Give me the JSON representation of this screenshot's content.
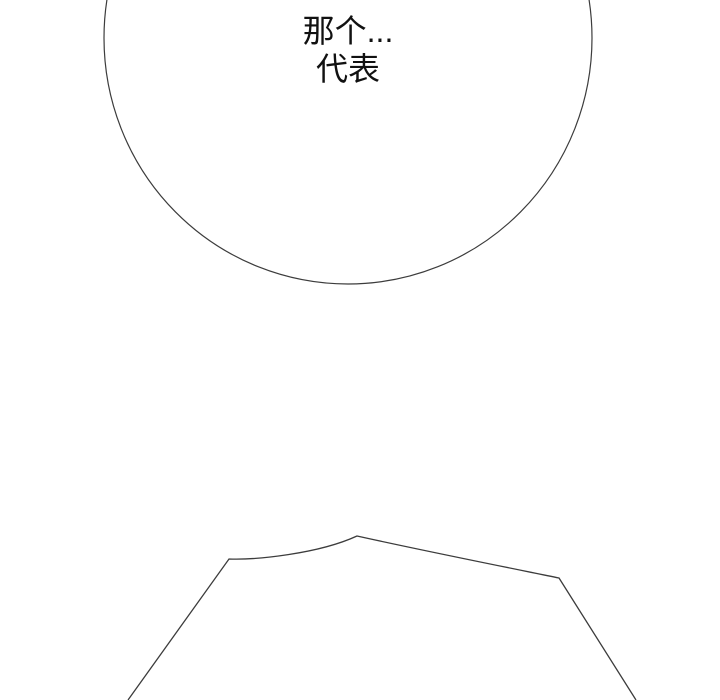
{
  "theme": {
    "bg_color": "#ffffff",
    "line_color": "#3c3c3c",
    "text_color": "#111111"
  },
  "panel": {
    "type": "comic-panel",
    "speech_bubble": {
      "lines": [
        "那个...",
        "代表"
      ]
    }
  }
}
